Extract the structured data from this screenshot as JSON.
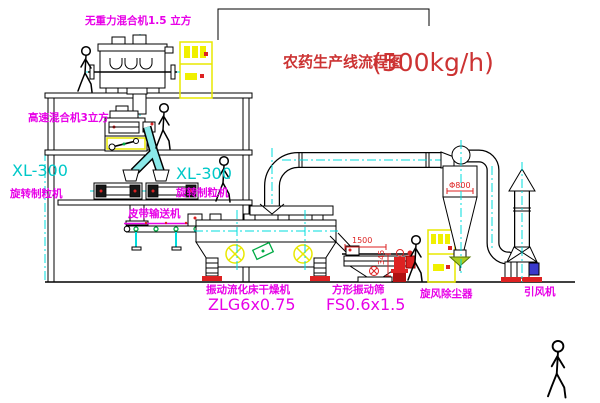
{
  "title": {
    "name": "农药生产线流程图",
    "capacity": "(500kg/h)"
  },
  "equipment": {
    "gravity_mixer": {
      "label": "无重力混合机1.5 立方"
    },
    "high_speed_mixer": {
      "label": "高速混合机3立方"
    },
    "granulator_left": {
      "model": "XL-300",
      "label": "旋转制粒机"
    },
    "granulator_right": {
      "model": "XL-300",
      "label": "旋转制粒机"
    },
    "belt_conveyor": {
      "label": "皮带输送机"
    },
    "dryer": {
      "label": "振动流化床干燥机",
      "model": "ZLG6x0.75"
    },
    "sieve": {
      "label": "方形振动筛",
      "model": "FS0.6x1.5",
      "dim_length": "1500",
      "dim_height": "345"
    },
    "cyclone": {
      "label": "旋风除尘器",
      "dim_diameter": "Φ800"
    },
    "fan": {
      "label": "引风机"
    }
  },
  "colors": {
    "label_magenta": "#e800e8",
    "model_cyan": "#00c8c8",
    "title_red": "#cc3333",
    "centerline_cyan": "#00dddd",
    "cabinet_yellow": "#f0f000",
    "alert_red": "#dd2222",
    "accent_green": "#00aa44"
  }
}
